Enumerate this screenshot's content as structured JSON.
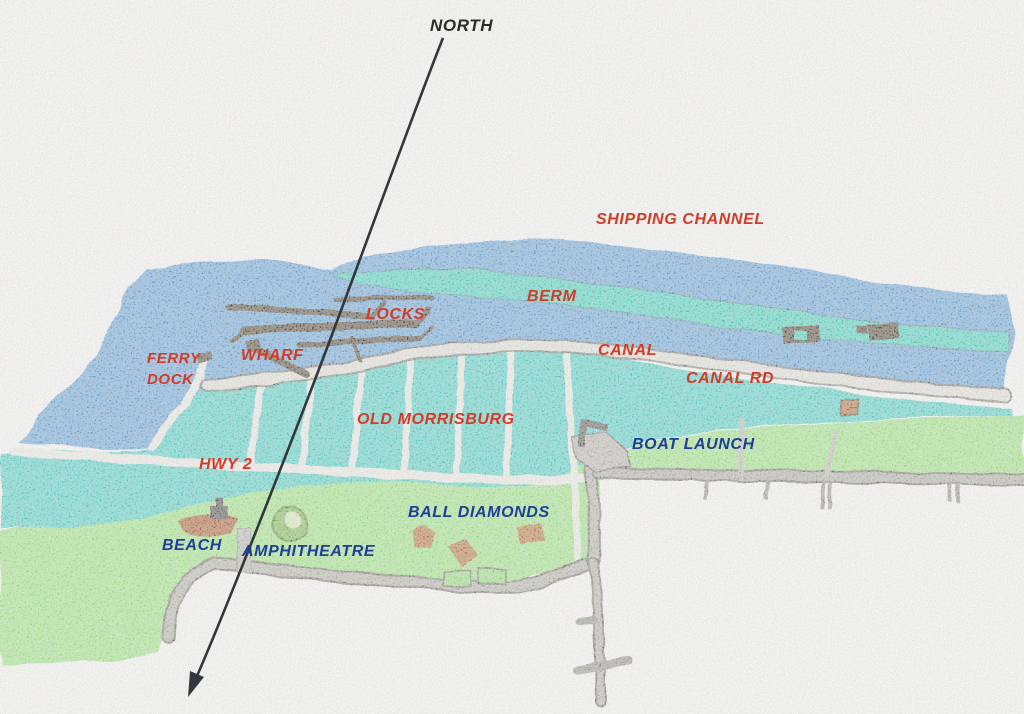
{
  "compass": {
    "label": "NORTH"
  },
  "labels": {
    "shipping_channel": "SHIPPING CHANNEL",
    "berm": "BERM",
    "locks": "LOCKS",
    "canal": "CANAL",
    "canal_rd": "CANAL RD",
    "wharf": "WHARF",
    "ferry_line1": "FERRY",
    "ferry_line2": "DOCK",
    "old_morrisburg": "OLD MORRISBURG",
    "hwy_2": "HWY 2",
    "boat_launch": "BOAT LAUNCH",
    "ball_diamonds": "BALL DIAMONDS",
    "beach": "BEACH",
    "amphitheatre": "AMPHITHEATRE"
  },
  "colors": {
    "label_red": "#d23b28",
    "label_navy": "#1e3f96",
    "label_black": "#2b2b2b",
    "paper": "#f3f2ee",
    "river_blue": "#5e9bcd",
    "flooded_teal": "#4cc9bd",
    "berm_teal": "#3fc9b4",
    "land_green": "#97dd79",
    "road_gray": "#a8a399",
    "street_light": "#e7e5de",
    "structure_dark_brown": "#4a3a28",
    "diamond_brown": "#b06c33"
  }
}
